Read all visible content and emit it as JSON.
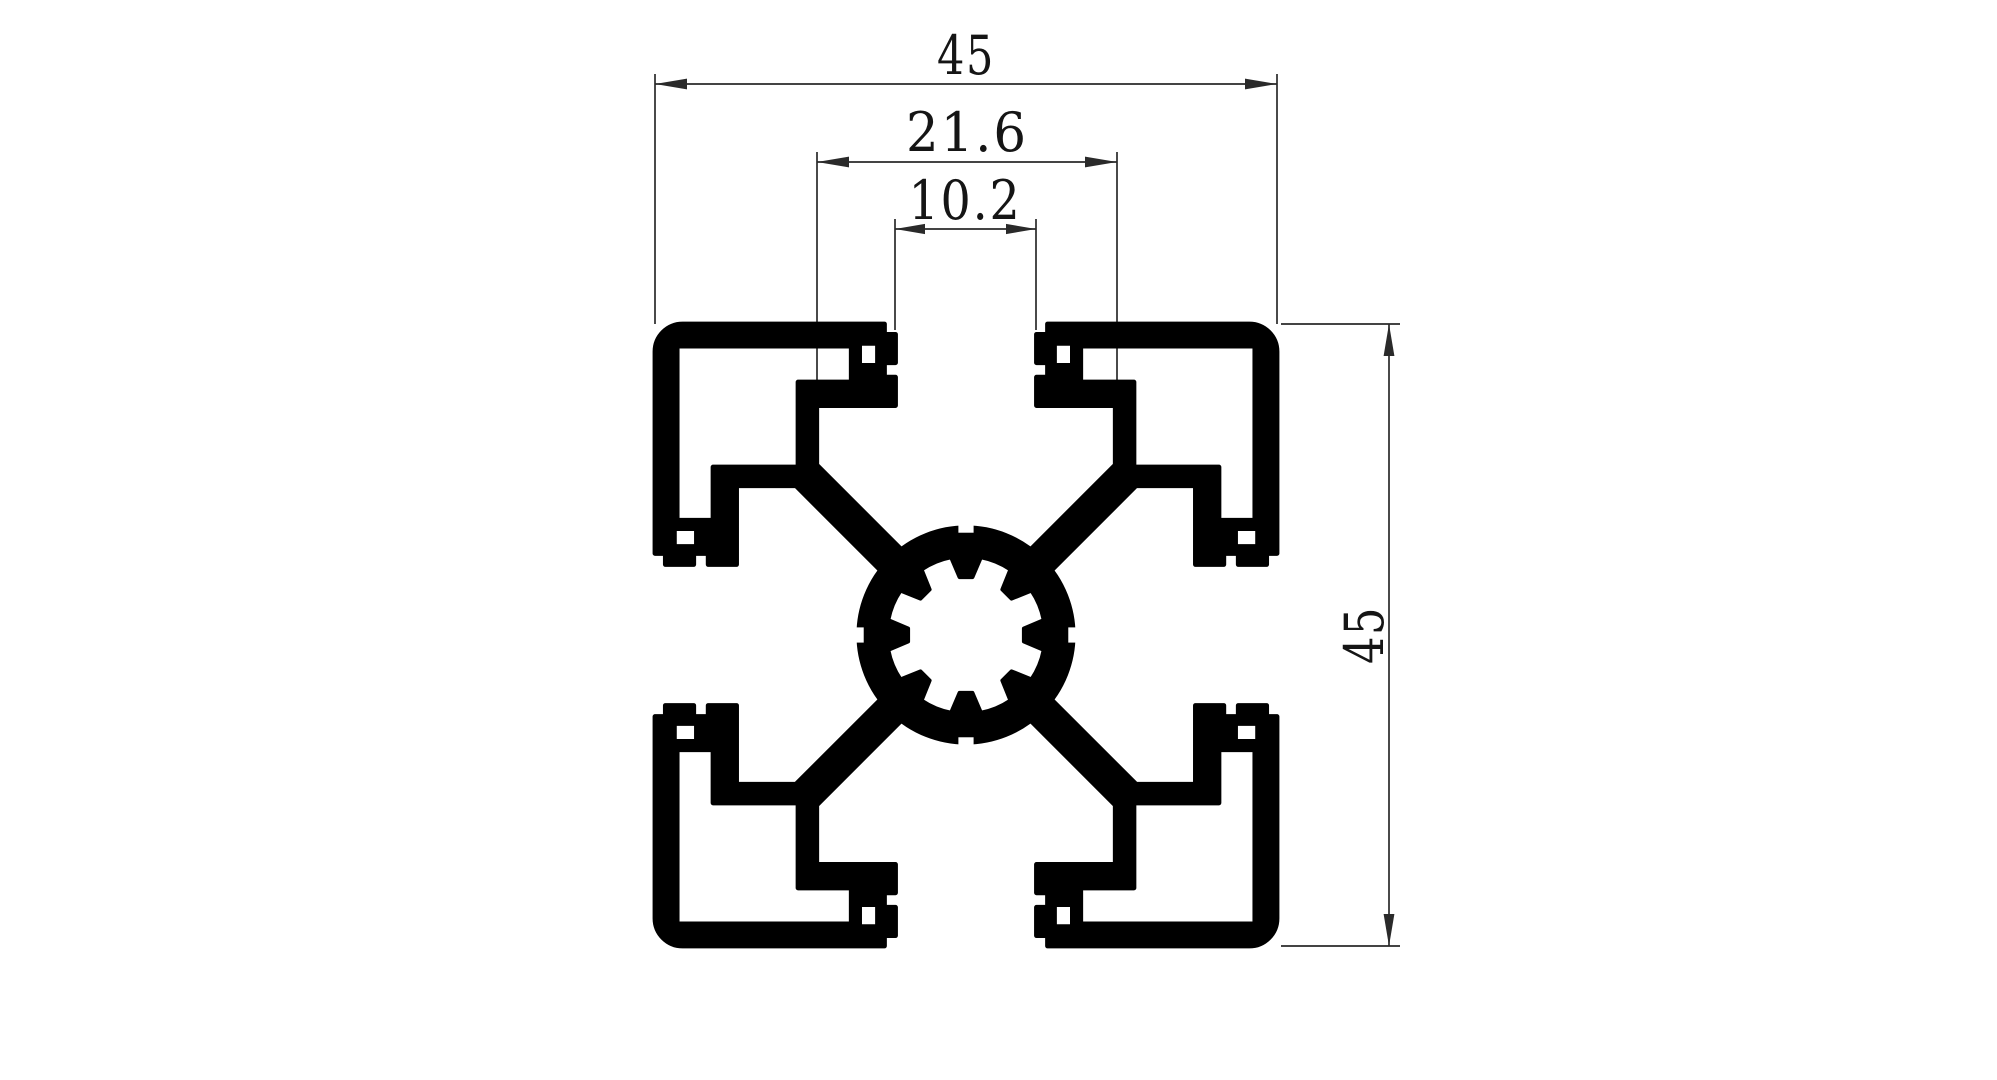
{
  "page": {
    "background": "#ffffff"
  },
  "drawing": {
    "type": "technical-drawing-cross-section",
    "profile_color": "#000000",
    "dimension_line_color": "#2a2a2a",
    "dimensions": {
      "overall_width": "45",
      "slot_inner_width": "21.6",
      "slot_opening_width": "10.2",
      "overall_height": "45"
    }
  }
}
